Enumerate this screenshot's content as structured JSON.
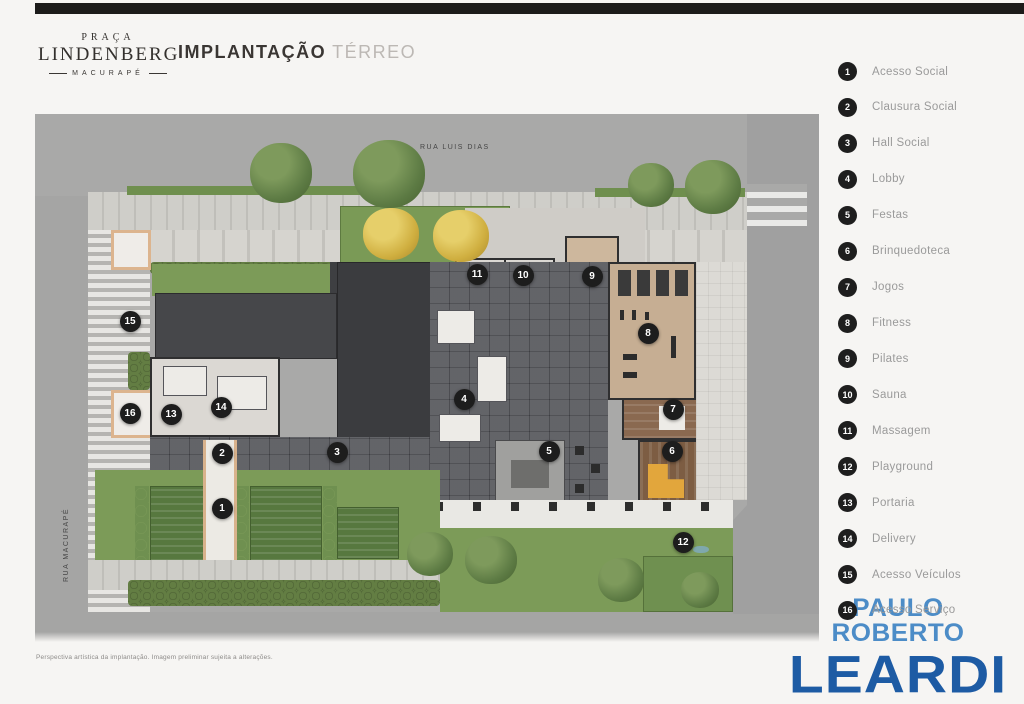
{
  "header": {
    "brand": {
      "line1": "PRAÇA",
      "line2": "LINDENBERG",
      "line3": "MACURAPÉ"
    },
    "title": {
      "primary": "IMPLANTAÇÃO",
      "secondary": "TÉRREO"
    }
  },
  "plan": {
    "streets": {
      "top": "RUA LUIS DIAS",
      "left": "RUA MACURAPÉ"
    },
    "markers": [
      {
        "n": "1",
        "x": 187,
        "y": 394
      },
      {
        "n": "2",
        "x": 187,
        "y": 339
      },
      {
        "n": "3",
        "x": 302,
        "y": 338
      },
      {
        "n": "4",
        "x": 429,
        "y": 285
      },
      {
        "n": "5",
        "x": 514,
        "y": 337
      },
      {
        "n": "6",
        "x": 637,
        "y": 337
      },
      {
        "n": "7",
        "x": 638,
        "y": 295
      },
      {
        "n": "8",
        "x": 613,
        "y": 219
      },
      {
        "n": "9",
        "x": 557,
        "y": 162
      },
      {
        "n": "10",
        "x": 488,
        "y": 161
      },
      {
        "n": "11",
        "x": 442,
        "y": 160
      },
      {
        "n": "12",
        "x": 648,
        "y": 428
      },
      {
        "n": "13",
        "x": 136,
        "y": 300
      },
      {
        "n": "14",
        "x": 186,
        "y": 293
      },
      {
        "n": "15",
        "x": 95,
        "y": 207
      },
      {
        "n": "16",
        "x": 95,
        "y": 299
      }
    ]
  },
  "legend": {
    "items": [
      {
        "n": "1",
        "label": "Acesso Social"
      },
      {
        "n": "2",
        "label": "Clausura Social"
      },
      {
        "n": "3",
        "label": "Hall Social"
      },
      {
        "n": "4",
        "label": "Lobby"
      },
      {
        "n": "5",
        "label": "Festas"
      },
      {
        "n": "6",
        "label": "Brinquedoteca"
      },
      {
        "n": "7",
        "label": "Jogos"
      },
      {
        "n": "8",
        "label": "Fitness"
      },
      {
        "n": "9",
        "label": "Pilates"
      },
      {
        "n": "10",
        "label": "Sauna"
      },
      {
        "n": "11",
        "label": "Massagem"
      },
      {
        "n": "12",
        "label": "Playground"
      },
      {
        "n": "13",
        "label": "Portaria"
      },
      {
        "n": "14",
        "label": "Delivery"
      },
      {
        "n": "15",
        "label": "Acesso Veículos"
      },
      {
        "n": "16",
        "label": "Acesso Serviço"
      }
    ]
  },
  "footer": {
    "disclaimer": "Perspectiva artística da implantação. Imagem preliminar sujeita a alterações.",
    "logo": {
      "top": "PAULO ROBERTO",
      "bottom": "LEARDI"
    }
  },
  "colors": {
    "logo_top_blue": "#4c8cc7",
    "logo_bottom_blue": "#1d5ba4",
    "marker_black": "#1d1d1d",
    "legend_text_gray": "#9a9a9a",
    "street_gray": "#a9a9a8",
    "lawn_green": "#7c9b58"
  }
}
